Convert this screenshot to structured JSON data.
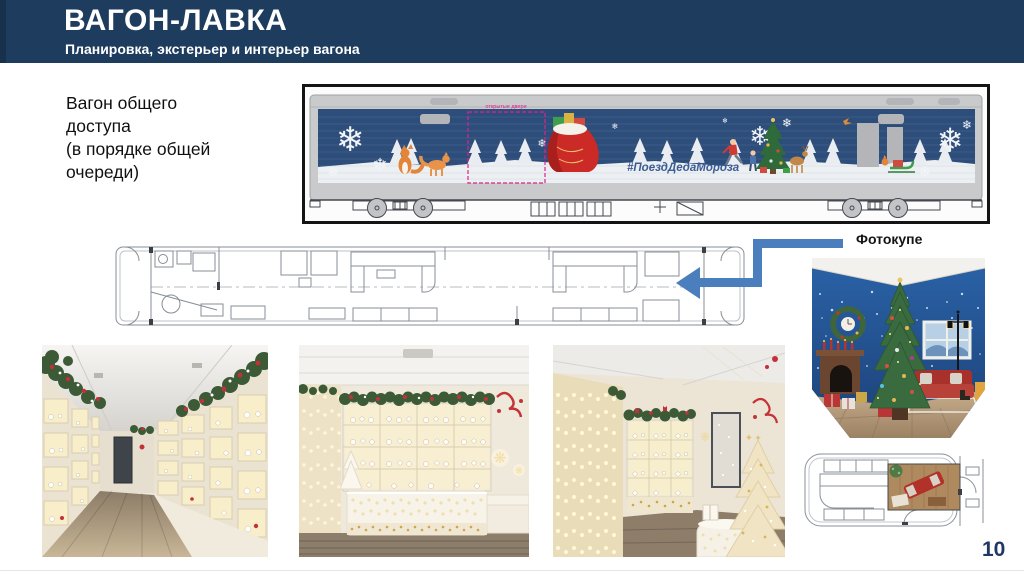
{
  "slide": {
    "title": "ВАГОН-ЛАВКА",
    "subtitle": "Планировка, экстерьер и интерьер вагона",
    "page_number": "10"
  },
  "note": {
    "lines": [
      "Вагон общего",
      "доступа",
      "(в порядке общей",
      "очереди)"
    ]
  },
  "exterior": {
    "hashtag": "#ПоездДедаМороза",
    "door_marking_label": "открытые двери"
  },
  "plan": {
    "callout_label": "Фотокупе"
  },
  "icons": {
    "snowflake": "❄",
    "sparkle_snowflake": "❋",
    "star": "✦"
  },
  "colors": {
    "header_navy": "#1d3c5e",
    "livery_navy": "#2d4d7b",
    "arrow_blue": "#4a7ebc",
    "marking_magenta": "#e0218a",
    "page_number_navy": "#203864",
    "accent_red": "#c4303a",
    "garland_green": "#3c5a36",
    "warm_light": "#f8eecb"
  }
}
